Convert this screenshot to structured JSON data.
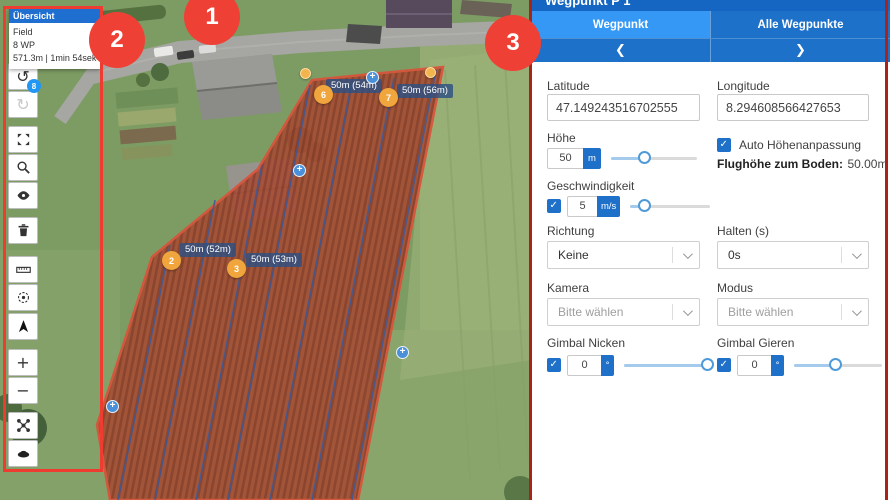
{
  "colors": {
    "accent_blue": "#1e70c8",
    "tab_active_blue": "#3598f4",
    "annotation_red": "#ef4036",
    "marker_orange": "#f1a53d",
    "field_overlay_red": "#a64b33",
    "label_badge_blue": "#2d5082"
  },
  "annotations": {
    "callout_1": "1",
    "callout_2": "2",
    "callout_3": "3"
  },
  "overview": {
    "title": "Übersicht",
    "field_name": "Field",
    "waypoint_count": "8 WP",
    "mission_stats": "571.3m | 1min 54sek"
  },
  "icons": {
    "undo": "↺",
    "redo": "↻",
    "plus": "+",
    "minus": "−",
    "prev": "❮",
    "next": "❯",
    "insert": "+"
  },
  "toolbar": {
    "undo_badge": "8"
  },
  "map": {
    "waypoint_labels": [
      {
        "text": "50m (52m)"
      },
      {
        "text": "50m (53m)"
      },
      {
        "text": "50m (54m)"
      },
      {
        "text": "50m (56m)"
      }
    ],
    "waypoint_markers": [
      {
        "num": "2"
      },
      {
        "num": "3"
      },
      {
        "num": "6"
      },
      {
        "num": "7"
      }
    ]
  },
  "panel": {
    "title": "Wegpunkt P 1",
    "tabs": {
      "waypoint": "Wegpunkt",
      "all_waypoints": "Alle Wegpunkte"
    },
    "latitude": {
      "label": "Latitude",
      "value": "47.149243516702555"
    },
    "longitude": {
      "label": "Longitude",
      "value": "8.294608566427653"
    },
    "altitude": {
      "label": "Höhe",
      "value": "50",
      "unit": "m"
    },
    "auto_altitude": {
      "label": "Auto Höhenanpassung"
    },
    "ground_altitude": {
      "label": "Flughöhe zum Boden:",
      "value": "50.00m"
    },
    "speed": {
      "label": "Geschwindigkeit",
      "value": "5",
      "unit": "m/s"
    },
    "direction": {
      "label": "Richtung",
      "value": "Keine"
    },
    "hold": {
      "label": "Halten (s)",
      "value": "0s"
    },
    "camera": {
      "label": "Kamera",
      "value": "Bitte wählen"
    },
    "mode": {
      "label": "Modus",
      "value": "Bitte wählen"
    },
    "gimbal_pitch": {
      "label": "Gimbal Nicken",
      "value": "0",
      "unit": "°"
    },
    "gimbal_yaw": {
      "label": "Gimbal Gieren",
      "value": "0",
      "unit": "°"
    }
  }
}
